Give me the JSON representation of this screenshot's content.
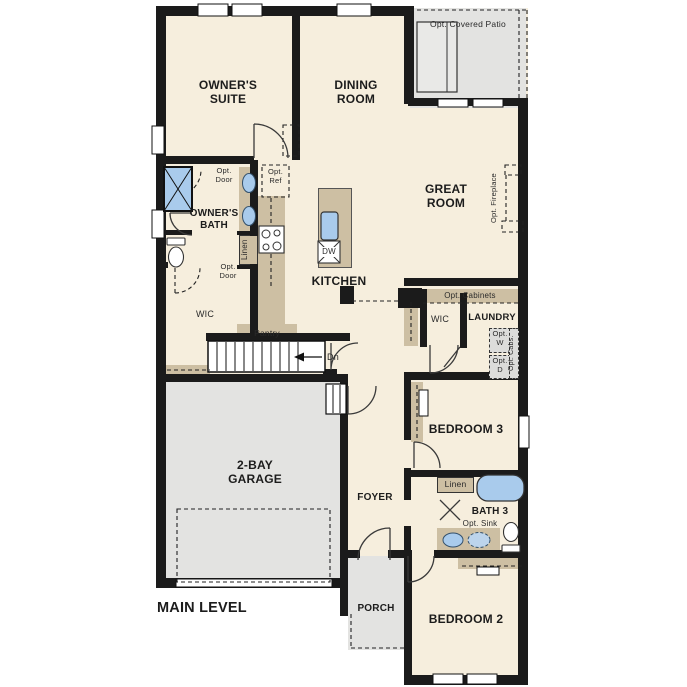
{
  "plan_title": "MAIN LEVEL",
  "rooms": {
    "owners_suite": "OWNER'S SUITE",
    "dining_room": "DINING ROOM",
    "great_room": "GREAT ROOM",
    "kitchen": "KITCHEN",
    "owners_bath": "OWNER'S BATH",
    "wic_left": "WIC",
    "wic_right": "WIC",
    "laundry": "LAUNDRY",
    "pantry": "Pantry",
    "bedroom_3": "BEDROOM 3",
    "bath_3": "BATH 3",
    "bedroom_2": "BEDROOM 2",
    "garage": "2-BAY GARAGE",
    "foyer": "FOYER",
    "porch": "PORCH",
    "patio": "Opt. Covered Patio",
    "linen_bath": "Linen",
    "linen_hall": "Linen"
  },
  "options": {
    "opt_door_upper": "Opt. Door",
    "opt_door_lower": "Opt. Door",
    "opt_ref": "Opt. Ref",
    "opt_fireplace": "Opt. Fireplace",
    "opt_cabinets": "Opt. Cabinets",
    "opt_washer": "Opt. W",
    "opt_dryer": "Opt. D",
    "opt_cabs": "Opt. Cabs.",
    "opt_sink": "Opt. Sink"
  },
  "fixtures": {
    "dishwasher": "DW",
    "stairs_direction": "Dn"
  },
  "colors": {
    "room_fill": "#f6eedd",
    "exterior_fill": "#e3e3e1",
    "cabinet_fill": "#cdbfa3",
    "fixture_blue": "#a9cbec",
    "wall": "#1b1b1b"
  }
}
